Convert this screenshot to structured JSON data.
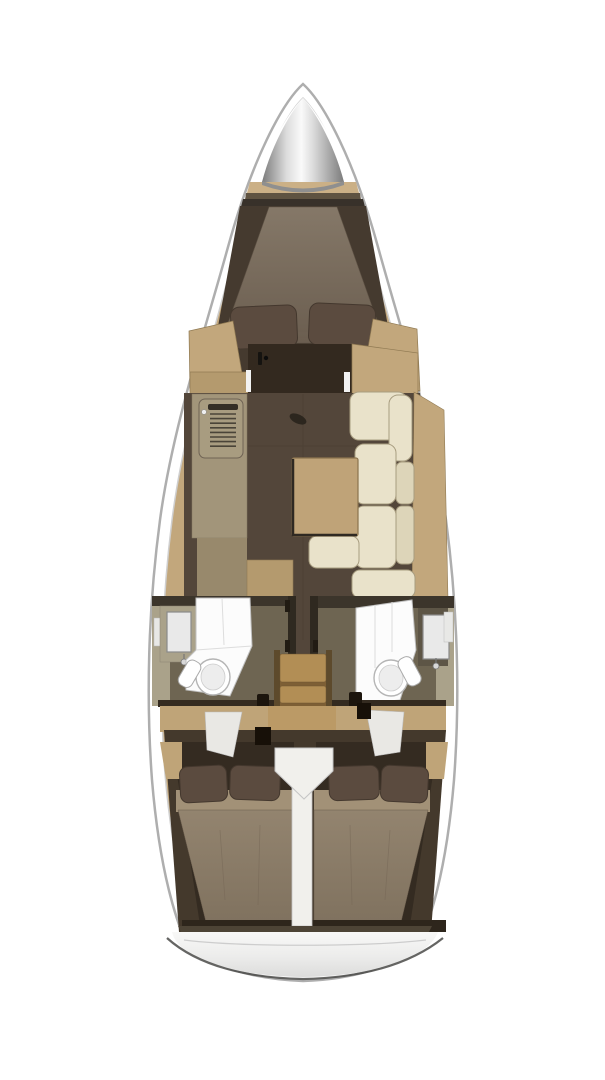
{
  "meta": {
    "title": "Sailboat interior layout plan (top view)",
    "type": "boat-floor-plan",
    "orientation": "bow-up"
  },
  "legend": {
    "anchor_locker": "Bow anchor locker",
    "forward_cabin": "Forward V-berth cabin",
    "saloon": "Saloon with table and settee",
    "galley": "Port galley with stove",
    "port_head": "Port head (shower / toilet / sink)",
    "starboard_head": "Starboard head (shower / toilet / sink)",
    "companionway": "Companionway stairs",
    "aft_cabin_port": "Port aft double cabin",
    "aft_cabin_starboard": "Starboard aft double cabin",
    "transom": "Stern transom"
  },
  "colors": {
    "hull_fill": "#ffffff",
    "hull_stroke": "#aeaeae",
    "inner_line": "#cfcfcf",
    "deck_wood": "#c2a77c",
    "wood_mid": "#b49a6e",
    "wood_edge": "#8f7952",
    "shelf_band": "#cbb086",
    "shelf_stripe": "#5f5341",
    "cone_edge": "#7b7b7b",
    "cone_mid": "#dcdcdc",
    "cone_highlight": "#fafafa",
    "cone_base": "#8f8f8f",
    "bow_gap": "#38312a",
    "fwd_floor": "#453a2f",
    "mattress_light": "#857868",
    "mattress_dark": "#6b5e50",
    "mattress_stroke": "#5f5346",
    "pillow": "#5b4b3f",
    "pillow_stroke": "#44382e",
    "door": "#33291f",
    "jamb": "#f2f2f2",
    "floor": "#53463a",
    "floor_seam": "#483c30",
    "galley": "#a2957a",
    "galley_dark": "#98896c",
    "stove_panel": "#a89c80",
    "stove_louver": "#4a4438",
    "stove_bar": "#332e26",
    "cream": "#e9e2ca",
    "cream_stroke": "#a89d80",
    "cream_back": "#ddd5b9",
    "table": "#bfa378",
    "table_stroke": "#8a734e",
    "table_shadow": "#2f2922",
    "handle": "#2c261e",
    "head_wall": "#6e6552",
    "head_dark": "#3c352b",
    "head_edge": "#2f2920",
    "head_outer": "#aaa28a",
    "vanity_dark": "#5d5546",
    "fixture": "#fcfcfc",
    "fixture_stroke": "#c0c0c0",
    "mirror": "#e9e9e9",
    "mirror_stroke": "#8a8a8a",
    "white_trim": "#e8e8e6",
    "tread": "#b28e55",
    "riser": "#7d5f35",
    "rail": "#5d4a2c",
    "stair_shadow": "#3f311e",
    "beam": "#342b20",
    "knob": "#1c150d",
    "aft_wood": "#bfa478",
    "aft_landing": "#bb9a66",
    "aft_surround": "#44392c",
    "aft_cabin": "#342b21",
    "aft_matt_top": "#93846f",
    "aft_matt_bot": "#80725f",
    "aft_matt_band": "#a29177",
    "aft_dark_band": "#2e261c",
    "sole_white": "#f1f0ec",
    "sole_stroke": "#c5c5c5",
    "entry_white": "#e9e8e4",
    "transom_band": "#4d4436",
    "stern_top": "#f8f8f7",
    "stern_mid": "#ececeb",
    "stern_bot": "#dcdcdb",
    "stern_edge": "#4a4a48",
    "stern_line": "#cdcdcd"
  }
}
